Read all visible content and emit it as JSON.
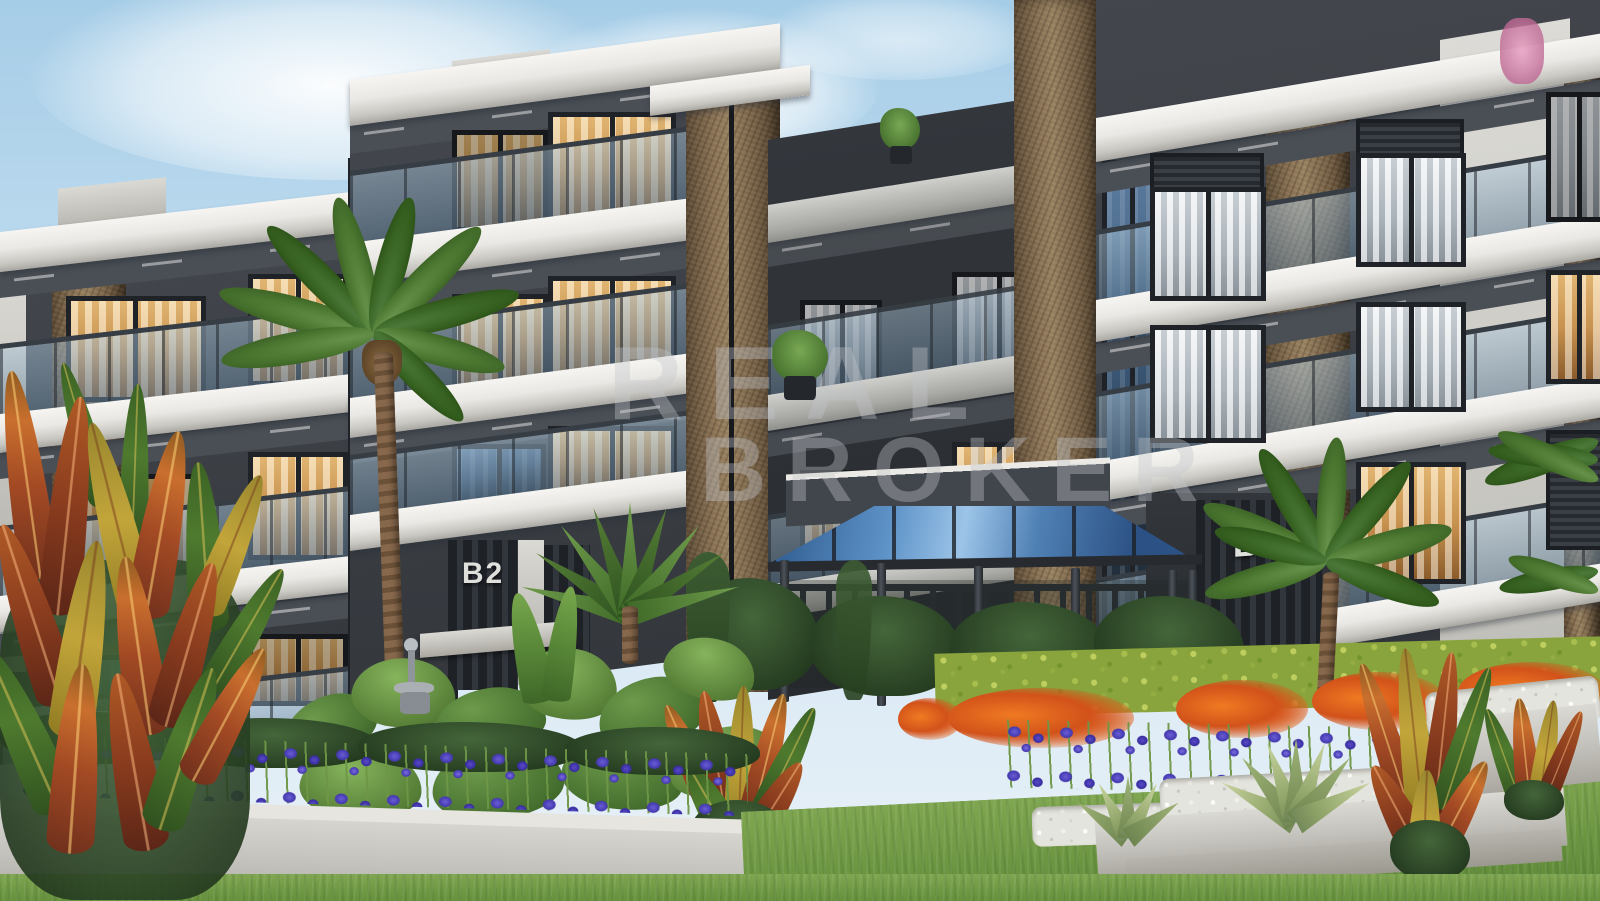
{
  "scene": {
    "type": "architectural-exterior-render",
    "description": "3D rendering of a modern multi-storey residential complex with white balcony slabs, brown marble columns, glass balustrades, a glass-roofed metal gazebo, palm trees, croton plants, purple iris beds, orange flower clusters, white pebble planters and lawn",
    "watermark": {
      "line1": "REAL",
      "line2": "BROKER"
    },
    "building_labels": {
      "left_block": "B2",
      "right_block": "B1"
    },
    "palette": {
      "sky_top": "#a6cde7",
      "sky_bottom": "#e8f1f7",
      "slab_white": "#f6f5f2",
      "wall_dark": "#34383d",
      "column_brown": "#8a7254",
      "window_amber": "#d09a55",
      "window_gray": "#b9c1c8",
      "glass_rail_blue": "#9ec2d8",
      "gazebo_glass_blue": "#5e93c8",
      "gazebo_frame": "#2c3036",
      "hedge_green": "#8aa43d",
      "iris_purple": "#4438ae",
      "flower_orange": "#d2521a",
      "pebble_white": "#e4e4de",
      "concrete_gray": "#c2c0ba",
      "lawn_green": "#6f9644"
    }
  }
}
